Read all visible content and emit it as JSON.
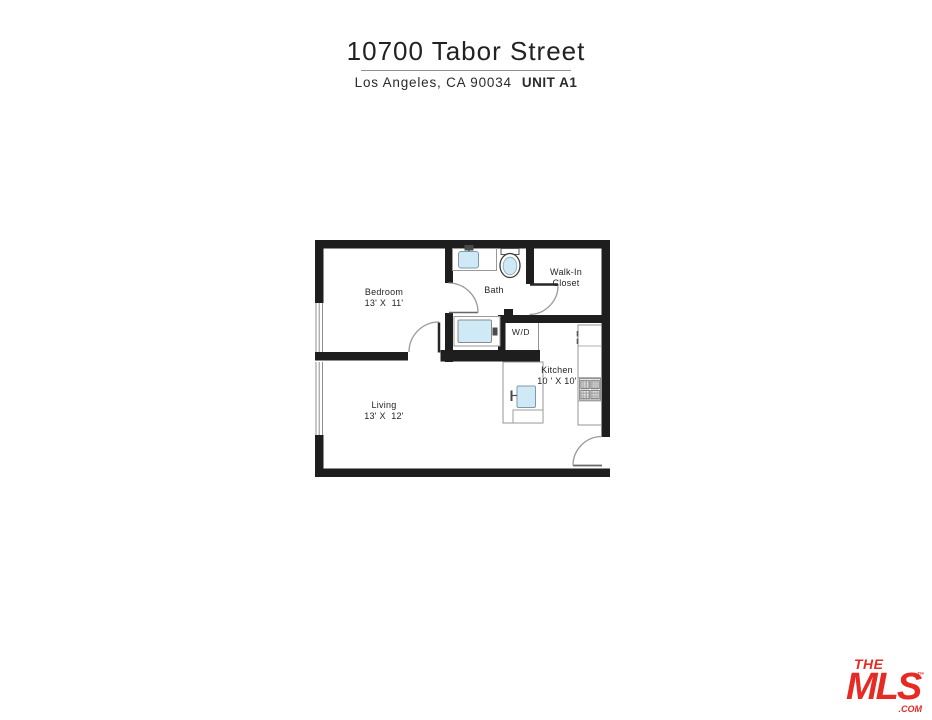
{
  "header": {
    "address": "10700 Tabor Street",
    "city_line": "Los Angeles, CA 90034",
    "unit": "UNIT A1"
  },
  "floorplan": {
    "rooms": {
      "bedroom": {
        "name": "Bedroom",
        "dims": "13' X  11'"
      },
      "bath": {
        "name": "Bath"
      },
      "walk_in_closet": {
        "line1": "Walk-In",
        "line2": "Closet"
      },
      "wd": {
        "name": "W/D"
      },
      "kitchen": {
        "name": "Kitchen",
        "dims": "10 ' X 10'"
      },
      "living": {
        "name": "Living",
        "dims": "13' X  12'"
      }
    }
  },
  "logo": {
    "the": "THE",
    "mls": "MLS",
    "tm": "™",
    "com": ".COM"
  },
  "colors": {
    "wall": "#1e1e1e",
    "thin_line": "#949494",
    "fixture_fill": "#cfe9f6",
    "accent_red": "#e62b25",
    "text": "#252525"
  }
}
